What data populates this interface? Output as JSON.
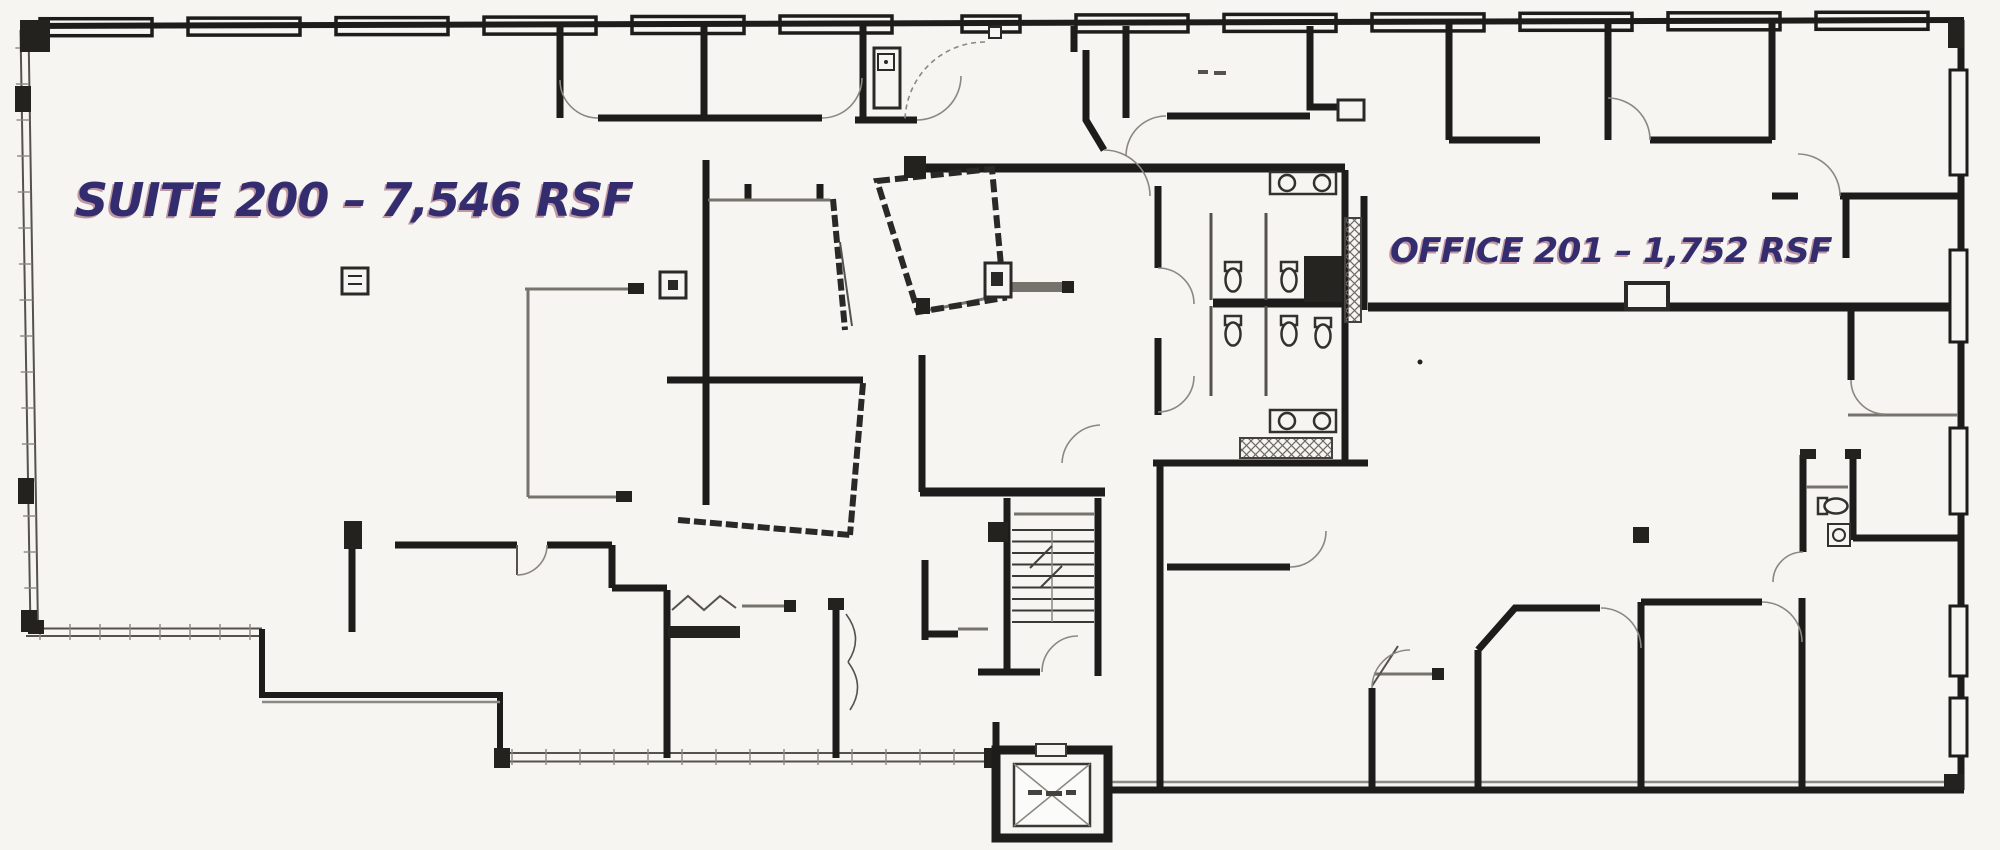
{
  "plan": {
    "suite_label": "SUITE 200 – 7,546 RSF",
    "office_label": "OFFICE 201 – 1,752 RSF"
  },
  "colors": {
    "paper": "#f6f5f2",
    "wall": "#1d1c1a",
    "thin_wall": "#76736c",
    "label": "#332c6e",
    "label_shadow": "#8c3a52"
  }
}
